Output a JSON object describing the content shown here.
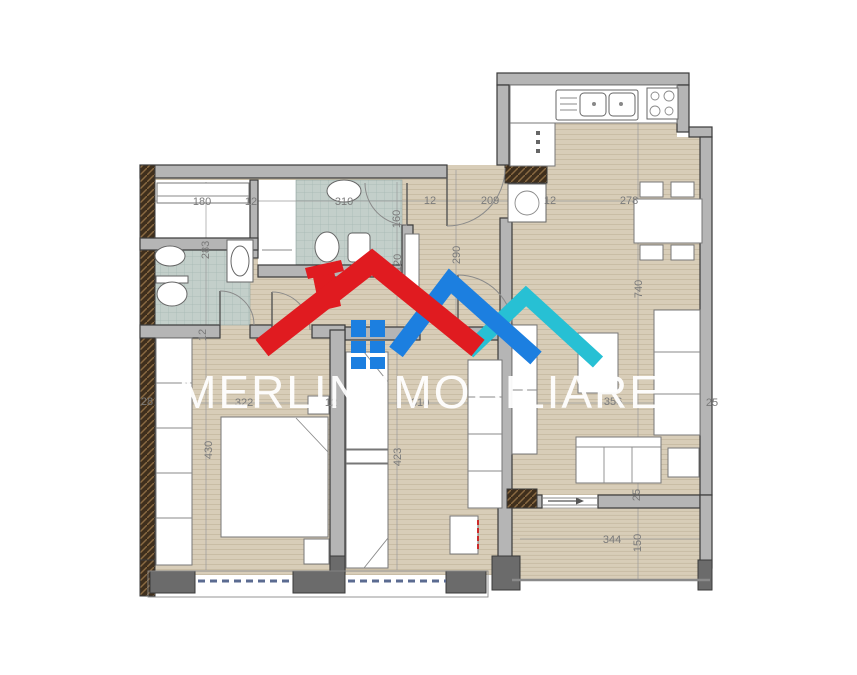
{
  "brand": {
    "name": "MERLIN IMOBILIARE",
    "colors": {
      "roof_red": "#e01b20",
      "roof_blue": "#1c7fe0",
      "roof_cyan": "#27c0d4",
      "window_blue": "#1c7fe0",
      "text": "#ffffff"
    }
  },
  "plan": {
    "type": "apartment-floor-plan",
    "colors": {
      "floor": "#d8cdb8",
      "floor_line": "#c9bda5",
      "tile": "#c3cfca",
      "tile_line": "#a5b8b2",
      "wall": "#b5b5b5",
      "wall_dark": "#6b6b6b",
      "wall_outline": "#3a3a3a",
      "structural": "#3f2f1d",
      "dim": "#7a7a7a",
      "window_dash": "#5b6b91",
      "accent_red": "#cc2a2a"
    },
    "dimensions": [
      {
        "text": "180",
        "x": 202,
        "y": 205,
        "rot": 0
      },
      {
        "text": "12",
        "x": 251,
        "y": 205,
        "rot": 0
      },
      {
        "text": "310",
        "x": 344,
        "y": 205,
        "rot": 0
      },
      {
        "text": "12",
        "x": 430,
        "y": 204,
        "rot": 0
      },
      {
        "text": "209",
        "x": 490,
        "y": 204,
        "rot": 0
      },
      {
        "text": "12",
        "x": 550,
        "y": 204,
        "rot": 0
      },
      {
        "text": "278",
        "x": 629,
        "y": 204,
        "rot": 0
      },
      {
        "text": "283",
        "x": 209,
        "y": 250,
        "rot": -90
      },
      {
        "text": "160",
        "x": 400,
        "y": 219,
        "rot": -90
      },
      {
        "text": "120",
        "x": 401,
        "y": 263,
        "rot": -90
      },
      {
        "text": "290",
        "x": 460,
        "y": 255,
        "rot": -90
      },
      {
        "text": "740",
        "x": 642,
        "y": 289,
        "rot": -90
      },
      {
        "text": "12",
        "x": 206,
        "y": 335,
        "rot": -90
      },
      {
        "text": "28",
        "x": 147,
        "y": 405,
        "rot": 0
      },
      {
        "text": "322",
        "x": 244,
        "y": 406,
        "rot": 0
      },
      {
        "text": "12",
        "x": 331,
        "y": 406,
        "rot": 0
      },
      {
        "text": "310",
        "x": 420,
        "y": 406,
        "rot": 0
      },
      {
        "text": "356",
        "x": 613,
        "y": 405,
        "rot": 0
      },
      {
        "text": "25",
        "x": 712,
        "y": 406,
        "rot": 0
      },
      {
        "text": "430",
        "x": 212,
        "y": 450,
        "rot": -90
      },
      {
        "text": "423",
        "x": 401,
        "y": 457,
        "rot": -90
      },
      {
        "text": "25",
        "x": 640,
        "y": 495,
        "rot": -90
      },
      {
        "text": "344",
        "x": 612,
        "y": 543,
        "rot": 0
      },
      {
        "text": "150",
        "x": 641,
        "y": 543,
        "rot": -90
      }
    ]
  }
}
